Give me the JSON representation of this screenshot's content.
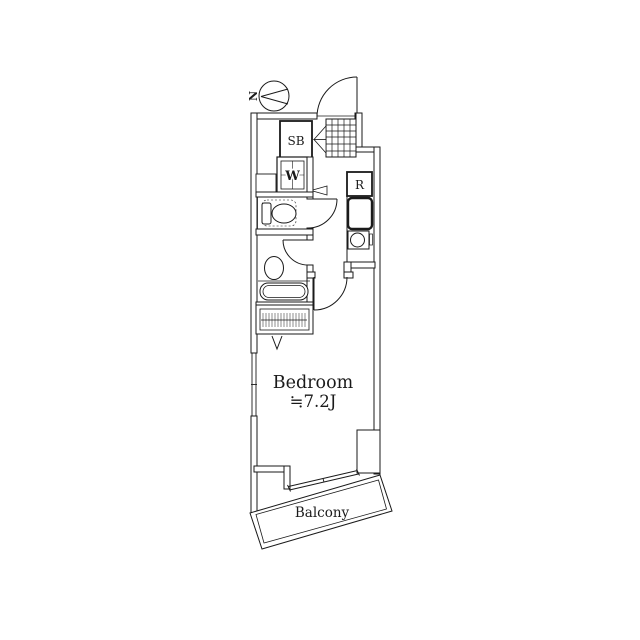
{
  "plan": {
    "north_label": "N",
    "labels": {
      "shoe_box": "SB",
      "washer": "W",
      "refrigerator": "R",
      "bedroom_name": "Bedroom",
      "bedroom_size": "≒7.2J",
      "balcony": "Balcony"
    },
    "colors": {
      "line": "#1a1a1a",
      "background": "#ffffff"
    }
  }
}
